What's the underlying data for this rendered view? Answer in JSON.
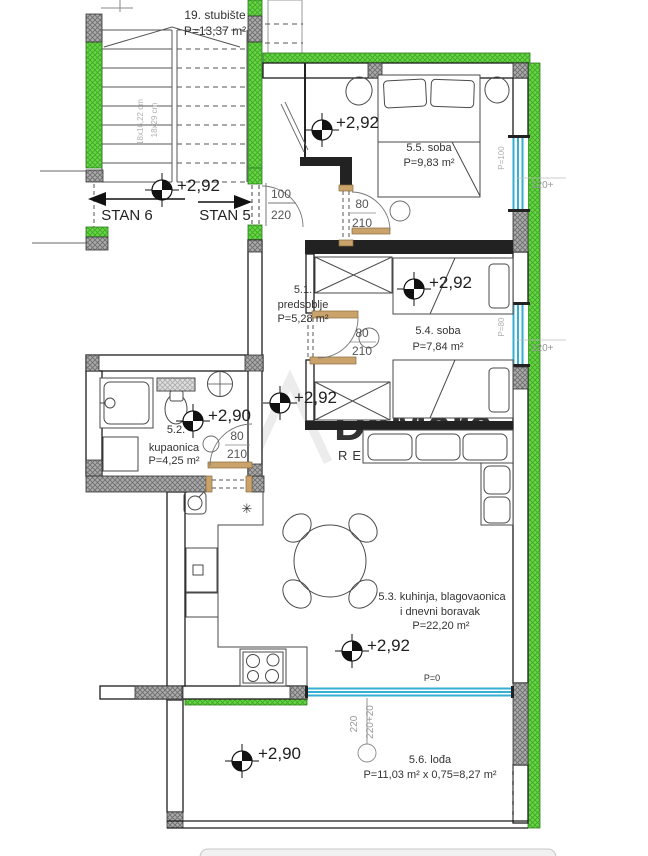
{
  "colors": {
    "wall_green": "#63d13e",
    "pier_gray": "#a8a8a8",
    "window_cyan": "#35aed3",
    "door_tan": "#c9a36b",
    "line_black": "#1c1c1c"
  },
  "stairwell": {
    "label": "19. stubište",
    "area": "P=13,37 m²",
    "riser_dim": "18x16,22 cm",
    "tread_dim": "18x29 cm"
  },
  "apartments": {
    "stan6": "STAN 6",
    "stan5": "STAN 5"
  },
  "entry_door": {
    "width": "100",
    "height": "220"
  },
  "levels": {
    "stairhall": "+2,92",
    "room55": "+2,92",
    "room54": "+2,92",
    "hall": "+2,92",
    "bath": "+2,90",
    "living": "+2,92",
    "loggia": "+2,90"
  },
  "rooms": {
    "r51": {
      "num": "5.1.",
      "name": "predsoblje",
      "area": "P=5,28 m²"
    },
    "r52": {
      "num": "5.2.",
      "name": "kupaonica",
      "area": "P=4,25 m²"
    },
    "r53": {
      "line1": "5.3. kuhinja, blagovaonica",
      "line2": "i dnevni boravak",
      "area": "P=22,20 m²"
    },
    "r54": {
      "label": "5.4. soba",
      "area": "P=7,84 m²"
    },
    "r55": {
      "label": "5.5. soba",
      "area": "P=9,83 m²"
    },
    "r56": {
      "label": "5.6. lođa",
      "area": "P=11,03 m² x 0,75=8,27 m²"
    }
  },
  "doors": {
    "d55": {
      "w": "80",
      "h": "210"
    },
    "d54": {
      "w": "80",
      "h": "210"
    },
    "d52": {
      "w": "80",
      "h": "210"
    }
  },
  "windows": {
    "w55": {
      "parapet": "P=100",
      "dim": "120+"
    },
    "w54": {
      "parapet": "P=80",
      "dim": "120+"
    },
    "slider": {
      "parapet": "P=0",
      "dim_a": "220",
      "dim_b": "220+20"
    }
  },
  "kitchen": {
    "boiler_symbol": "✳"
  },
  "watermark": {
    "name": "DeMare",
    "tagline": "REAL ESTATE"
  }
}
